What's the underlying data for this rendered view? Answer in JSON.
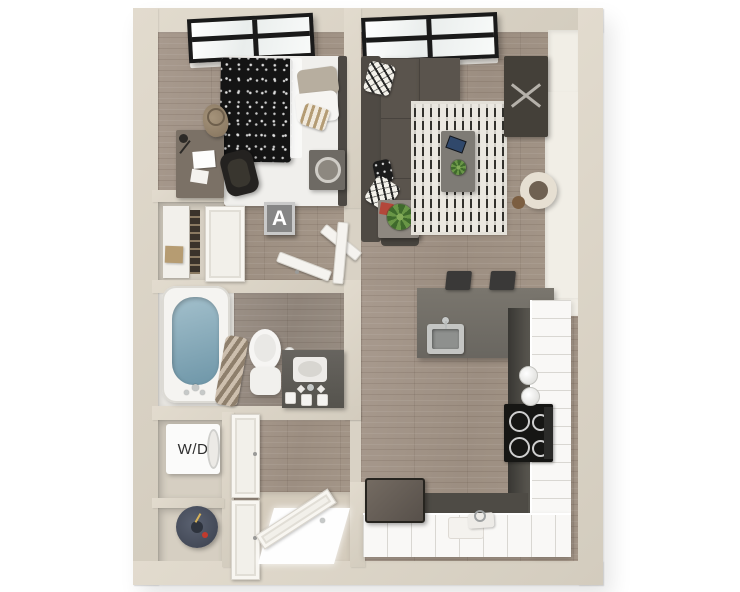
{
  "floorplan": {
    "unit_label": "A",
    "washer_dryer_label": "W/D",
    "colors": {
      "background": "#ffffff",
      "wall": "#d9d2c5",
      "wood_floor": "#a39588",
      "entry_floor": "#d4cbbc",
      "tile_counter": "#f9f8f6",
      "island_counter": "#6f6c65",
      "sofa": "#57514b",
      "rug_stripe": "#191814",
      "duvet": "#141414",
      "tub_water": "#84a9bb",
      "water_heater": "#4a5160",
      "stove": "#161614",
      "unit_label_bg": "#868686",
      "window_frame": "#1a1a1a"
    }
  }
}
